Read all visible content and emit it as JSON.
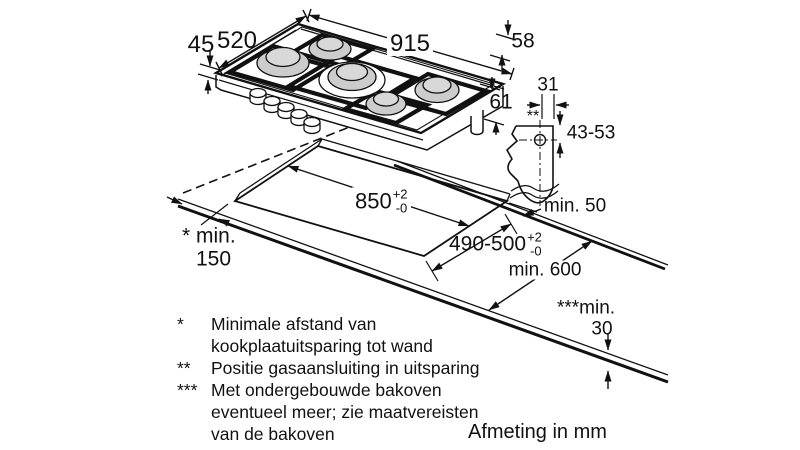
{
  "drawing": {
    "unit_note": "Afmeting in mm",
    "colors": {
      "ink": "#111111",
      "burner_cap": "#cccccc",
      "burner_cap_top": "#d8d8d8"
    },
    "labels": {
      "depth_total": "520",
      "width_total": "915",
      "height_front": "45",
      "height_rear": "58",
      "gas_height": "61",
      "gas_offset": "31",
      "gas_marker": "**",
      "gas_depth_range": "43-53",
      "min_rear": "min. 50",
      "cutout_length": "850",
      "cutout_length_plus": "+2",
      "cutout_length_minus": "-0",
      "cutout_depth": "490-500",
      "cutout_depth_plus": "+2",
      "cutout_depth_minus": "-0",
      "min_counter_depth": "min. 600",
      "min_wall_line1": "* min.",
      "min_wall_line2": "150",
      "min_oven_line1": "***min.",
      "min_oven_line2": "30"
    },
    "footnotes": [
      {
        "marker": "*",
        "lines": [
          "Minimale afstand van",
          "kookplaatuitsparing tot wand"
        ]
      },
      {
        "marker": "**",
        "lines": [
          "Positie gasaansluiting in uitsparing"
        ]
      },
      {
        "marker": "***",
        "lines": [
          "Met ondergebouwde bakoven",
          "eventueel meer; zie maatvereisten",
          "van de bakoven"
        ]
      }
    ]
  }
}
